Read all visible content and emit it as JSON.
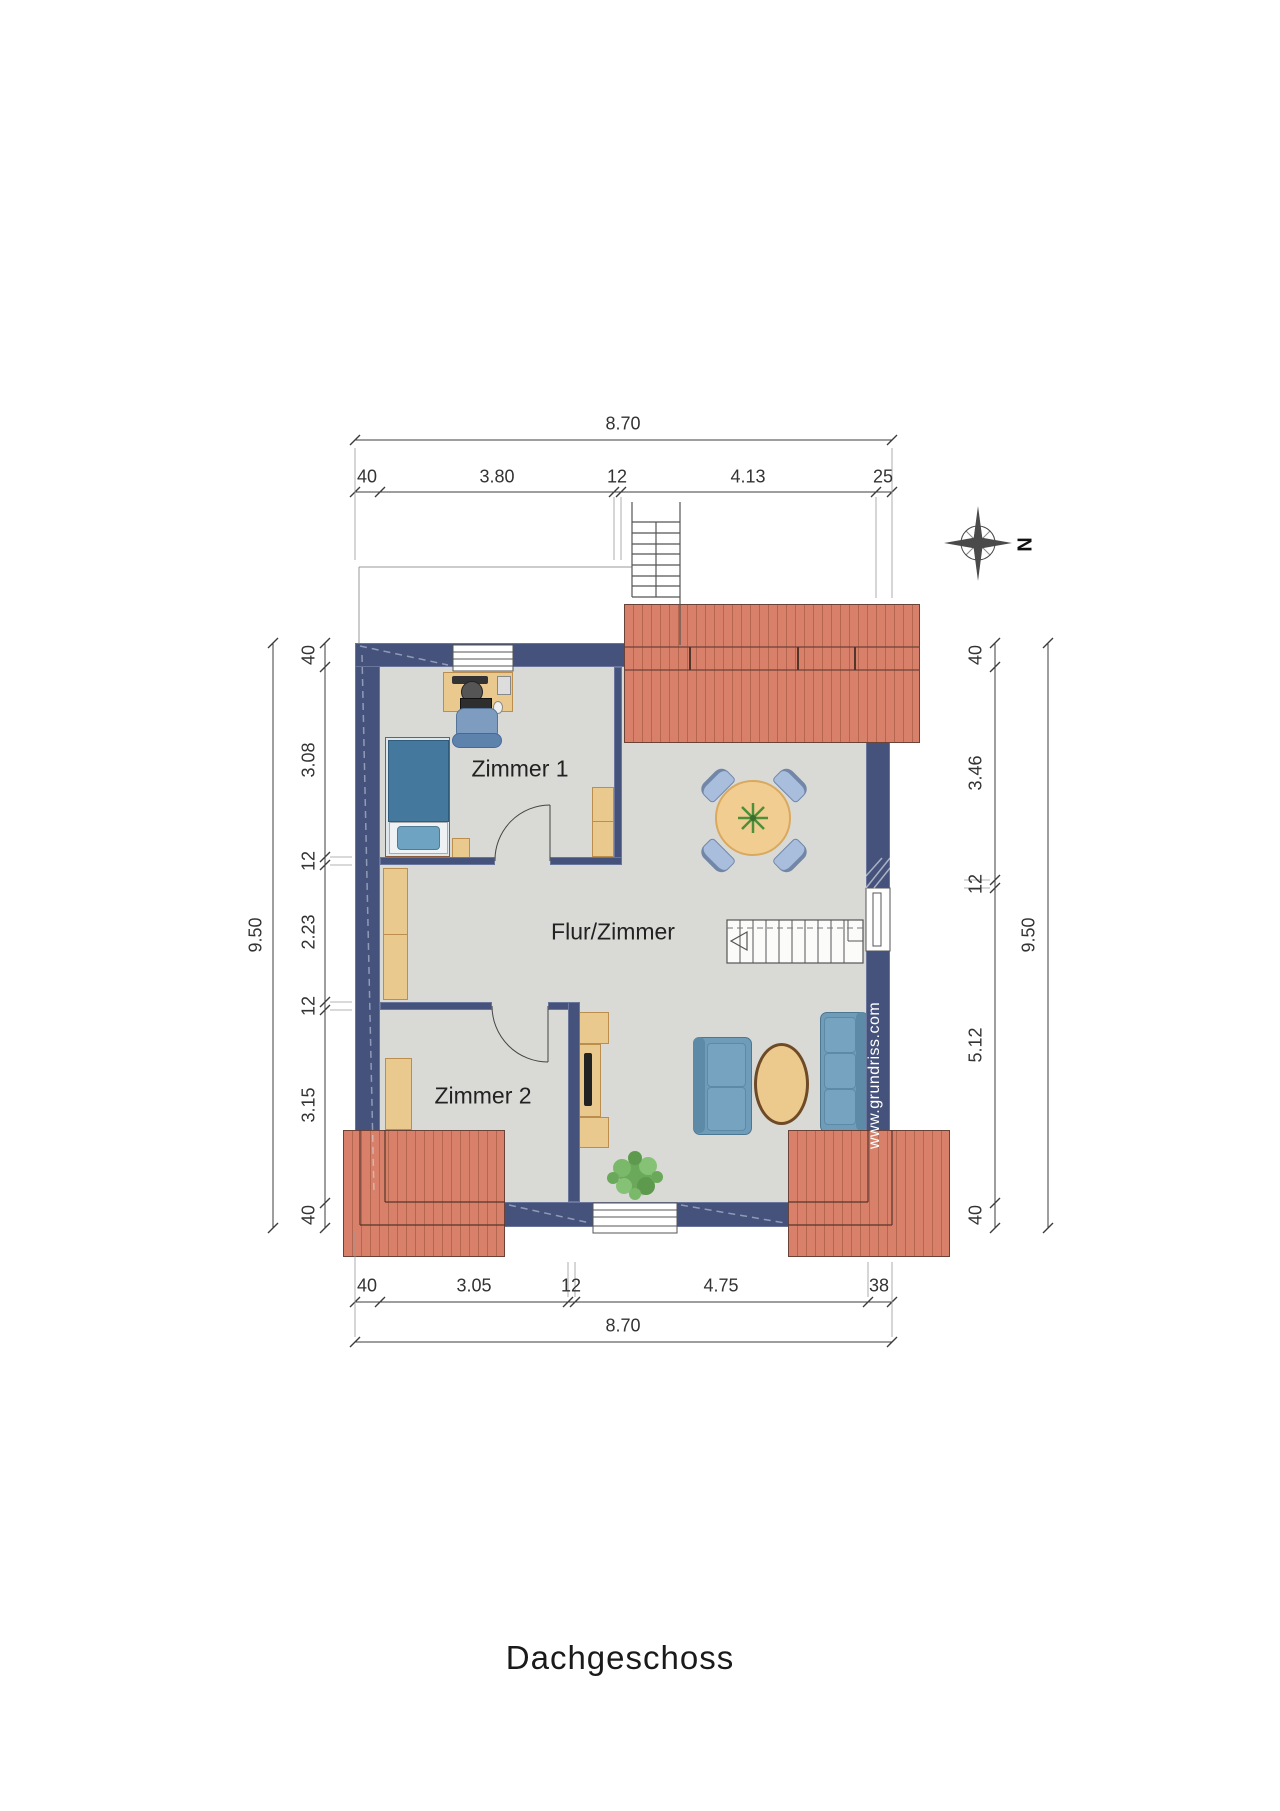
{
  "title": "Dachgeschoss",
  "watermark": "www.grundriss.com",
  "compass": {
    "letter": "N"
  },
  "rooms": {
    "zimmer1": "Zimmer 1",
    "flur": "Flur/Zimmer",
    "zimmer2": "Zimmer 2"
  },
  "dimensions": {
    "top": {
      "overall": "8.70",
      "segments": [
        "40",
        "3.80",
        "12",
        "4.13",
        "25"
      ]
    },
    "bottom": {
      "overall": "8.70",
      "segments": [
        "40",
        "3.05",
        "12",
        "4.75",
        "38"
      ]
    },
    "left": {
      "overall": "9.50",
      "segments": [
        "40",
        "3.08",
        "12",
        "2.23",
        "12",
        "3.15",
        "40"
      ]
    },
    "right": {
      "overall": "9.50",
      "segments": [
        "40",
        "3.46",
        "12",
        "5.12",
        "40"
      ]
    }
  },
  "colors": {
    "wall": "#45527b",
    "floor": "#d9dad6",
    "roof": "#d8806a",
    "roof_stripe": "#b4664e",
    "wood": "#eac98f",
    "sofa": "#6f9cb8",
    "dining_chair": "#a9bedc",
    "bed": "#44789c",
    "plant": "#5e9a4d"
  }
}
